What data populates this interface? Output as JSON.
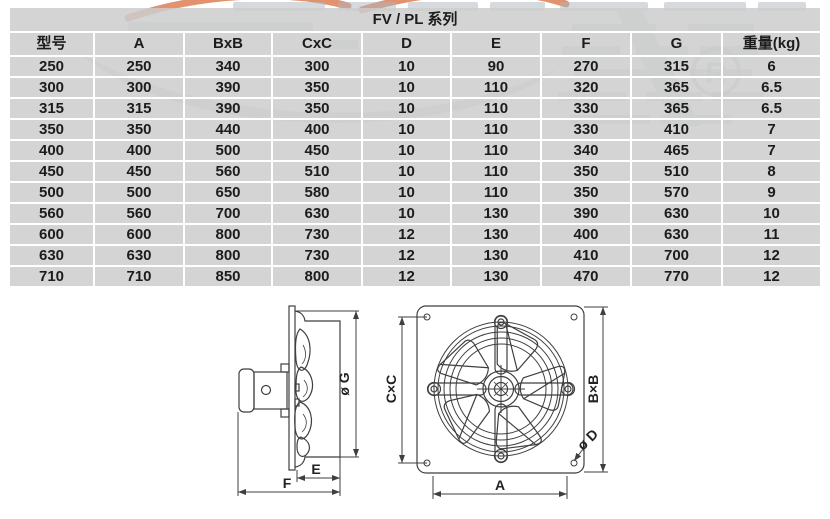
{
  "page": {
    "title_row": "FV / PL 系列"
  },
  "table": {
    "headers": [
      "型号",
      "A",
      "BxB",
      "CxC",
      "D",
      "E",
      "F",
      "G",
      "重量(kg)"
    ],
    "rows": [
      [
        "250",
        "250",
        "340",
        "300",
        "10",
        "90",
        "270",
        "315",
        "6"
      ],
      [
        "300",
        "300",
        "390",
        "350",
        "10",
        "110",
        "320",
        "365",
        "6.5"
      ],
      [
        "315",
        "315",
        "390",
        "350",
        "10",
        "110",
        "330",
        "365",
        "6.5"
      ],
      [
        "350",
        "350",
        "440",
        "400",
        "10",
        "110",
        "330",
        "410",
        "7"
      ],
      [
        "400",
        "400",
        "500",
        "450",
        "10",
        "110",
        "340",
        "465",
        "7"
      ],
      [
        "450",
        "450",
        "560",
        "510",
        "10",
        "110",
        "350",
        "510",
        "8"
      ],
      [
        "500",
        "500",
        "650",
        "580",
        "10",
        "110",
        "350",
        "570",
        "9"
      ],
      [
        "560",
        "560",
        "700",
        "630",
        "10",
        "130",
        "390",
        "630",
        "10"
      ],
      [
        "600",
        "600",
        "800",
        "730",
        "12",
        "130",
        "400",
        "630",
        "11"
      ],
      [
        "630",
        "630",
        "800",
        "730",
        "12",
        "130",
        "410",
        "700",
        "12"
      ],
      [
        "710",
        "710",
        "850",
        "800",
        "12",
        "130",
        "470",
        "770",
        "12"
      ]
    ]
  },
  "diagram": {
    "side_view": {
      "dim_g": "ø G",
      "dim_e": "E",
      "dim_f": "F"
    },
    "front_view": {
      "dim_cxc": "C×C",
      "dim_bxb": "B×B",
      "dim_a": "A",
      "dim_d": "ø D"
    }
  },
  "watermark": {
    "registered": "R"
  },
  "colors": {
    "cell_bg": "#d4d4d4",
    "grid_line": "#ffffff",
    "text": "#1c1c1c",
    "drawing_line": "#3f3f3f",
    "watermark_gray": "#aeb6c1",
    "watermark_orange": "#de7f55"
  }
}
